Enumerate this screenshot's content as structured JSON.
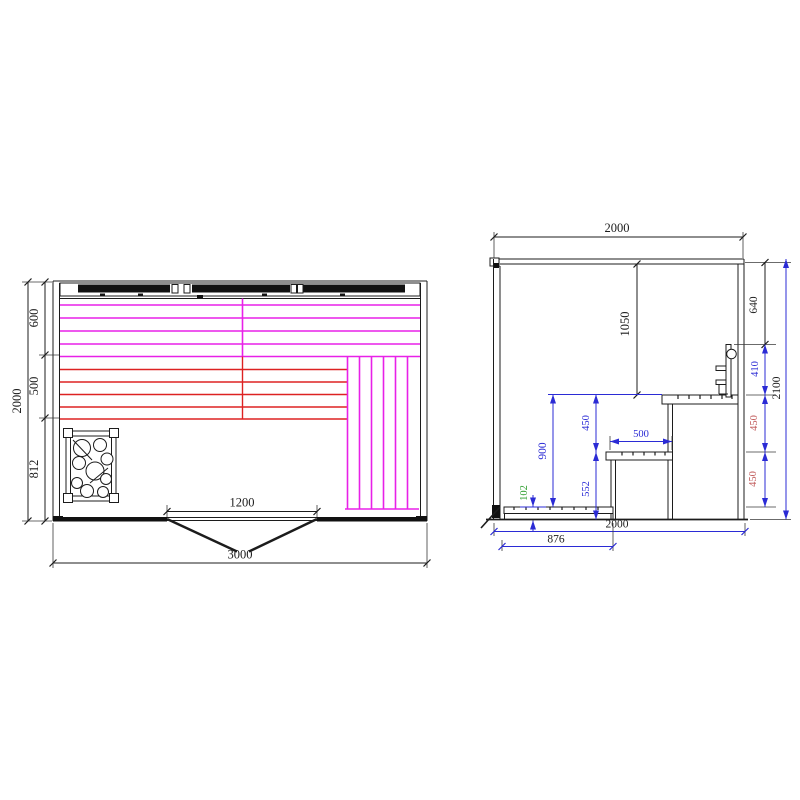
{
  "plan": {
    "depth_total": "2000",
    "zone_top": "600",
    "zone_mid": "500",
    "zone_bottom": "812",
    "door_width": "1200",
    "width_total": "3000"
  },
  "elevation": {
    "width_top": "2000",
    "interior_height": "1050",
    "c640": "640",
    "c410": "410",
    "c450_upper": "450",
    "c450_lower": "450",
    "height_total": "2100",
    "h900": "900",
    "step_450": "450",
    "h552": "552",
    "h102": "102",
    "bench_depth": "500",
    "width_bottom": "2000",
    "run_876": "876"
  },
  "colors": {
    "heater_magenta": "#e821e8",
    "heater_red": "#dd2222",
    "dimension_blue": "#2b2bd5",
    "dimension_red_text": "#c05858",
    "dimension_green_text": "#2e9e2e",
    "line_black": "#1c1c1c"
  }
}
